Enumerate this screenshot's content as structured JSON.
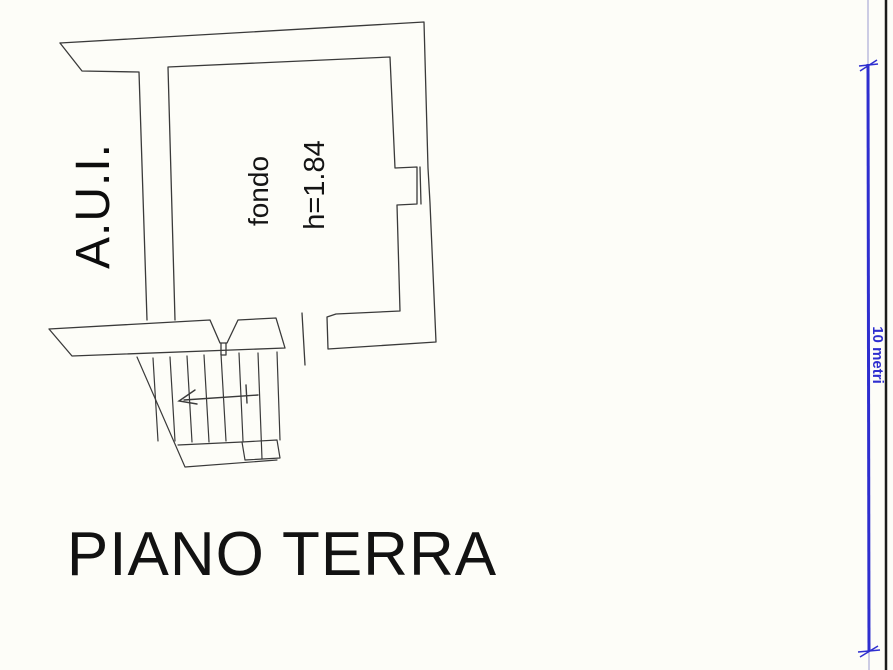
{
  "page": {
    "background": "#fdfdf8"
  },
  "plan": {
    "annex_label": "A.U.I.",
    "room": {
      "name": "fondo",
      "height": "h=1.84"
    },
    "title": "PIANO TERRA"
  },
  "scale_bar": {
    "label": "10 metri"
  },
  "colors": {
    "wall_line": "#3a3a3a",
    "arrow_line": "#3a3a3a",
    "scale_blue": "#2e2ecf",
    "scale_light": "#9a9ad0",
    "border_black": "#1b1b1b"
  }
}
